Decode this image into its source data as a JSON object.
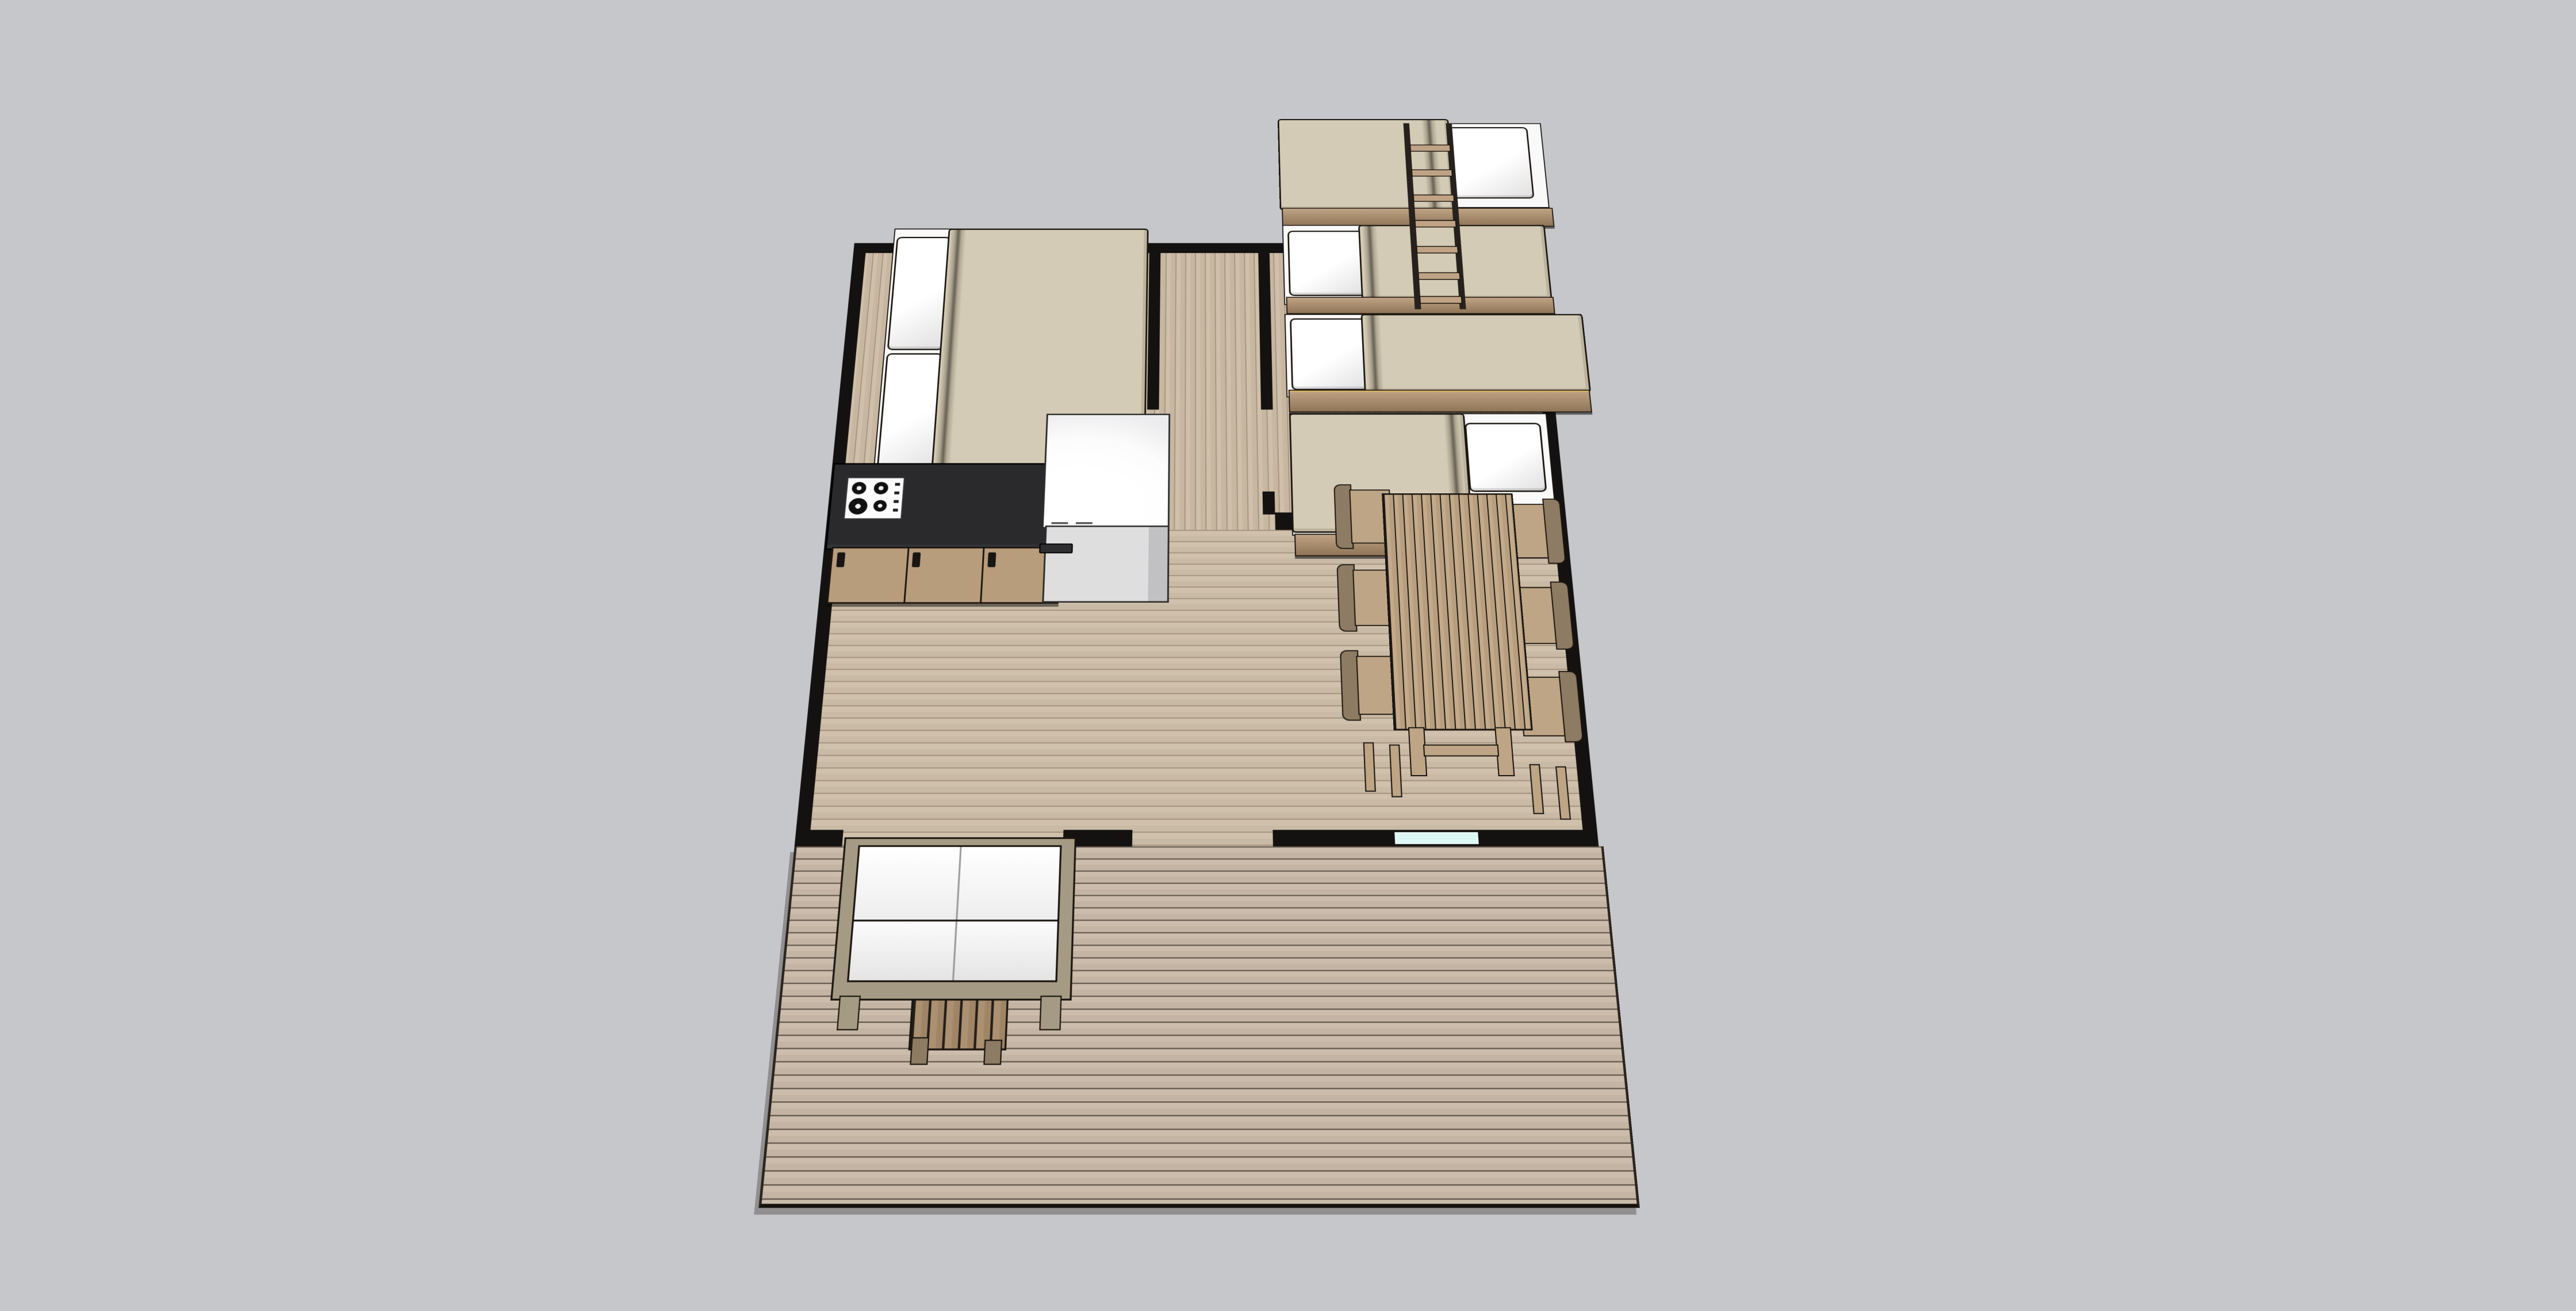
{
  "view": {
    "type": "3d-model-overhead-perspective",
    "description": "Top-down perspective render of a furnished small cabin: two bedrooms and hallway at the rear, open kitchen/living and dining area in the middle, front wall with entry openings and a window, and a large plank deck with outdoor seating at the front.",
    "background_color": "#c6c7cb",
    "text_labels": []
  },
  "colors": {
    "background": "#c6c7cb",
    "wall": "#141210",
    "outline": "#1a150f",
    "floor_a": "#cfc0ab",
    "floor_b": "#c7b7a1",
    "floor_joint": "#a6947f",
    "living_a": "#d0c1ac",
    "living_b": "#c9baa5",
    "living_joint": "#a3917c",
    "deck_a": "#cbbcab",
    "deck_b": "#c3b4a3",
    "deck_joint": "#60564a",
    "mattress": "#d4cbb6",
    "bedding_white": "#f9f9f9",
    "platform": "#bfa384",
    "counter": "#2a2a2c",
    "cabinet": "#b79d7c",
    "appliance": "#fcfcfc",
    "appliance_gray": "#dededf",
    "wood": "#bda585",
    "wood_dark": "#8d7b63",
    "glass": "#dcf8f4"
  },
  "rooms": [
    {
      "name": "bedroom-left",
      "label": "Bedroom with double bed"
    },
    {
      "name": "bedroom-bunks",
      "label": "Bunk room with two bunk beds"
    },
    {
      "name": "hallway",
      "label": "Central hallway"
    },
    {
      "name": "kitchen-living",
      "label": "Open kitchen / living area"
    },
    {
      "name": "dining-area",
      "label": "Dining area"
    },
    {
      "name": "deck",
      "label": "Front deck"
    }
  ],
  "furniture": {
    "double_bed": {
      "label": "Double bed",
      "pillows": 2,
      "bedding": "beige duvet, white pillows"
    },
    "bunk_bed_upper_unit": {
      "label": "Bunk bed unit 1 (upper + lower)",
      "pillow_positions": [
        "right",
        "left"
      ]
    },
    "bunk_bed_lower_unit": {
      "label": "Bunk bed unit 2 (upper + lower)",
      "pillow_positions": [
        "left",
        "right"
      ]
    },
    "bunk_ladder": {
      "label": "Bunk ladder",
      "rungs": 7
    },
    "kitchen_island": {
      "label": "Kitchen island, black countertop",
      "burners": 4,
      "control_knobs": 4,
      "cabinet_doors": 3
    },
    "refrigerator_unit": {
      "label": "Refrigerator / appliance block"
    },
    "dining_table": {
      "label": "Slatted dining table",
      "slats": 13
    },
    "dining_chairs": {
      "label": "Dining chairs",
      "count": 6,
      "arrangement": "3 per long side"
    },
    "sofa": {
      "label": "Outdoor two-seat sofa",
      "seats": 2,
      "cushions": "white"
    },
    "side_table": {
      "label": "Slatted side table"
    },
    "front_openings": {
      "label": "Front wall openings",
      "count": 2
    },
    "window": {
      "label": "Front window",
      "glazing_color": "#dcf8f4"
    }
  }
}
